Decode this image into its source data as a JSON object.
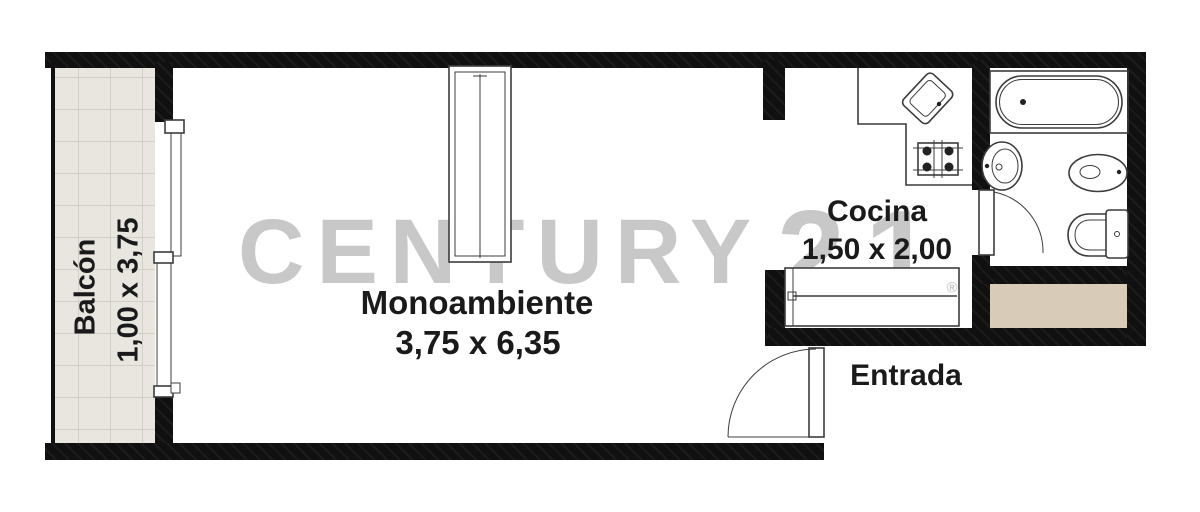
{
  "title": "Monoambiente floor plan",
  "watermark": {
    "brand": "CENTURY",
    "number": "21",
    "registered": "®"
  },
  "rooms": {
    "balcony": {
      "label": "Balcón",
      "dims": "1,00 x 3,75"
    },
    "studio": {
      "label": "Monoambiente",
      "dims": "3,75 x 6,35"
    },
    "kitchen": {
      "label": "Cocina",
      "dims": "1,50 x 2,00"
    },
    "entrance": {
      "label": "Entrada"
    }
  },
  "fixtures": [
    "wardrobe",
    "sliding-window",
    "kitchen-sink",
    "stove",
    "kitchen-counter",
    "bathtub",
    "washbasin",
    "bidet",
    "toilet",
    "bathroom-door",
    "entrance-door"
  ],
  "colors": {
    "wall": "#101010",
    "tile_floor": "#e9e6e0",
    "tile_line": "#d2cfc8",
    "shaft": "#d8ccb8",
    "watermark": "#c8c8c8",
    "label": "#1a1a1a",
    "fixture_stroke": "#3c3c3c"
  }
}
